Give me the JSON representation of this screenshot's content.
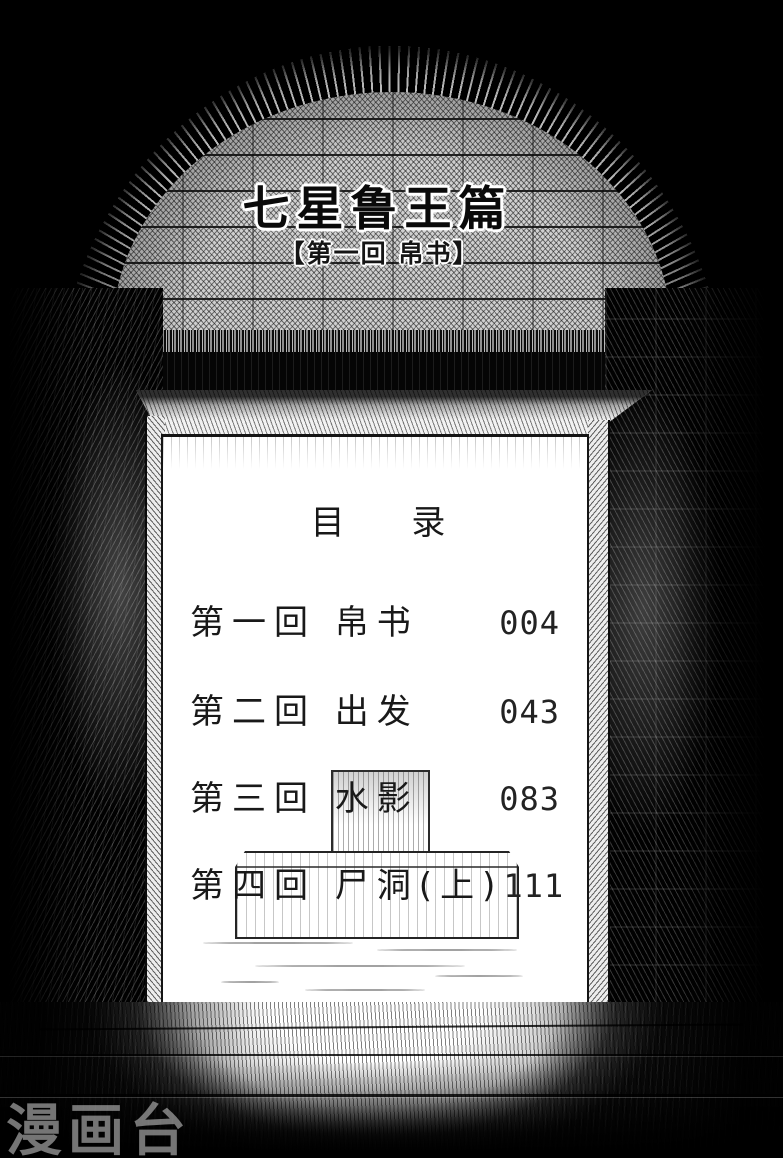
{
  "header": {
    "series_title": "七星鲁王篇",
    "chapter_banner": "【第一回 帛书】"
  },
  "toc": {
    "heading": "目 录",
    "entries": [
      {
        "label": "第一回 帛书",
        "page": "004"
      },
      {
        "label": "第二回 出发",
        "page": "043"
      },
      {
        "label": "第三回 水影",
        "page": "083"
      },
      {
        "label": "第四回 尸洞(上)",
        "page": "111"
      }
    ]
  },
  "watermark": {
    "text": "漫画台"
  },
  "colors": {
    "background": "#000000",
    "paper": "#ffffff",
    "ink": "#191919",
    "brick": "#cfcfcf",
    "watermark": "#d5d5d5"
  }
}
